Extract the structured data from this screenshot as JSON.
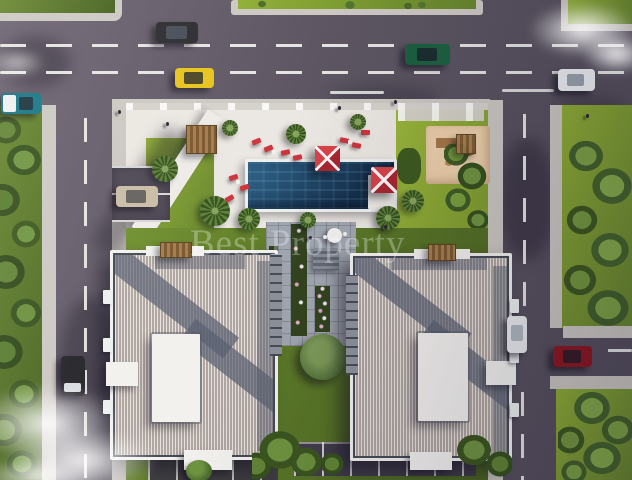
{
  "image": {
    "watermark_text": "Best Property",
    "description": "Top-down aerial 3D architectural rendering of a residential complex: two hipped-tile-roof apartment buildings, central courtyard garden with flower planters, swimming pool with red square parasols and sun loungers, wooden pergola, children's playground with sand pit, parking bays, surrounding streets with dashed lane markings, passing cars, lawns, palm trees and cloud wisps."
  },
  "theme": {
    "asphalt": "#5d5662",
    "asphalt_dark": "#474151",
    "lane_line": "#f1f1ee",
    "sidewalk": "#ccc8c3",
    "deck": "#ebe7e2",
    "grass_bright": "#8fae35",
    "grass_mid": "#67862e",
    "grass_dark": "#44601f",
    "tree_light": "#6f9440",
    "tree_dark": "#35511e",
    "pool_light": "#30638a",
    "pool_dark": "#16314d",
    "umbrella_red": "#d8434a",
    "umbrella_red_dark": "#a82631",
    "lounger_red": "#cf343c",
    "sand": "#ecd0ab",
    "wood": "#9b7748",
    "roof_tile": "#cfc5bf",
    "roof_ridge": "#454b56",
    "roof_shade": "#596070",
    "building_white": "#f2f1ee",
    "facade_grey": "#8d929b",
    "watermark_color": "rgba(255,255,255,0.30)"
  },
  "vehicles": {
    "sedan_dark": "#2b2b31",
    "hatch_yellow": "#e6c41e",
    "suv_teal": "#157585",
    "sedan_green": "#1d6040",
    "sedan_white": "#eef0f3",
    "parked_beige": "#c9bda6",
    "sedan_black": "#232329",
    "parked_white": "#e9ecef",
    "sedan_red": "#8c1722"
  }
}
